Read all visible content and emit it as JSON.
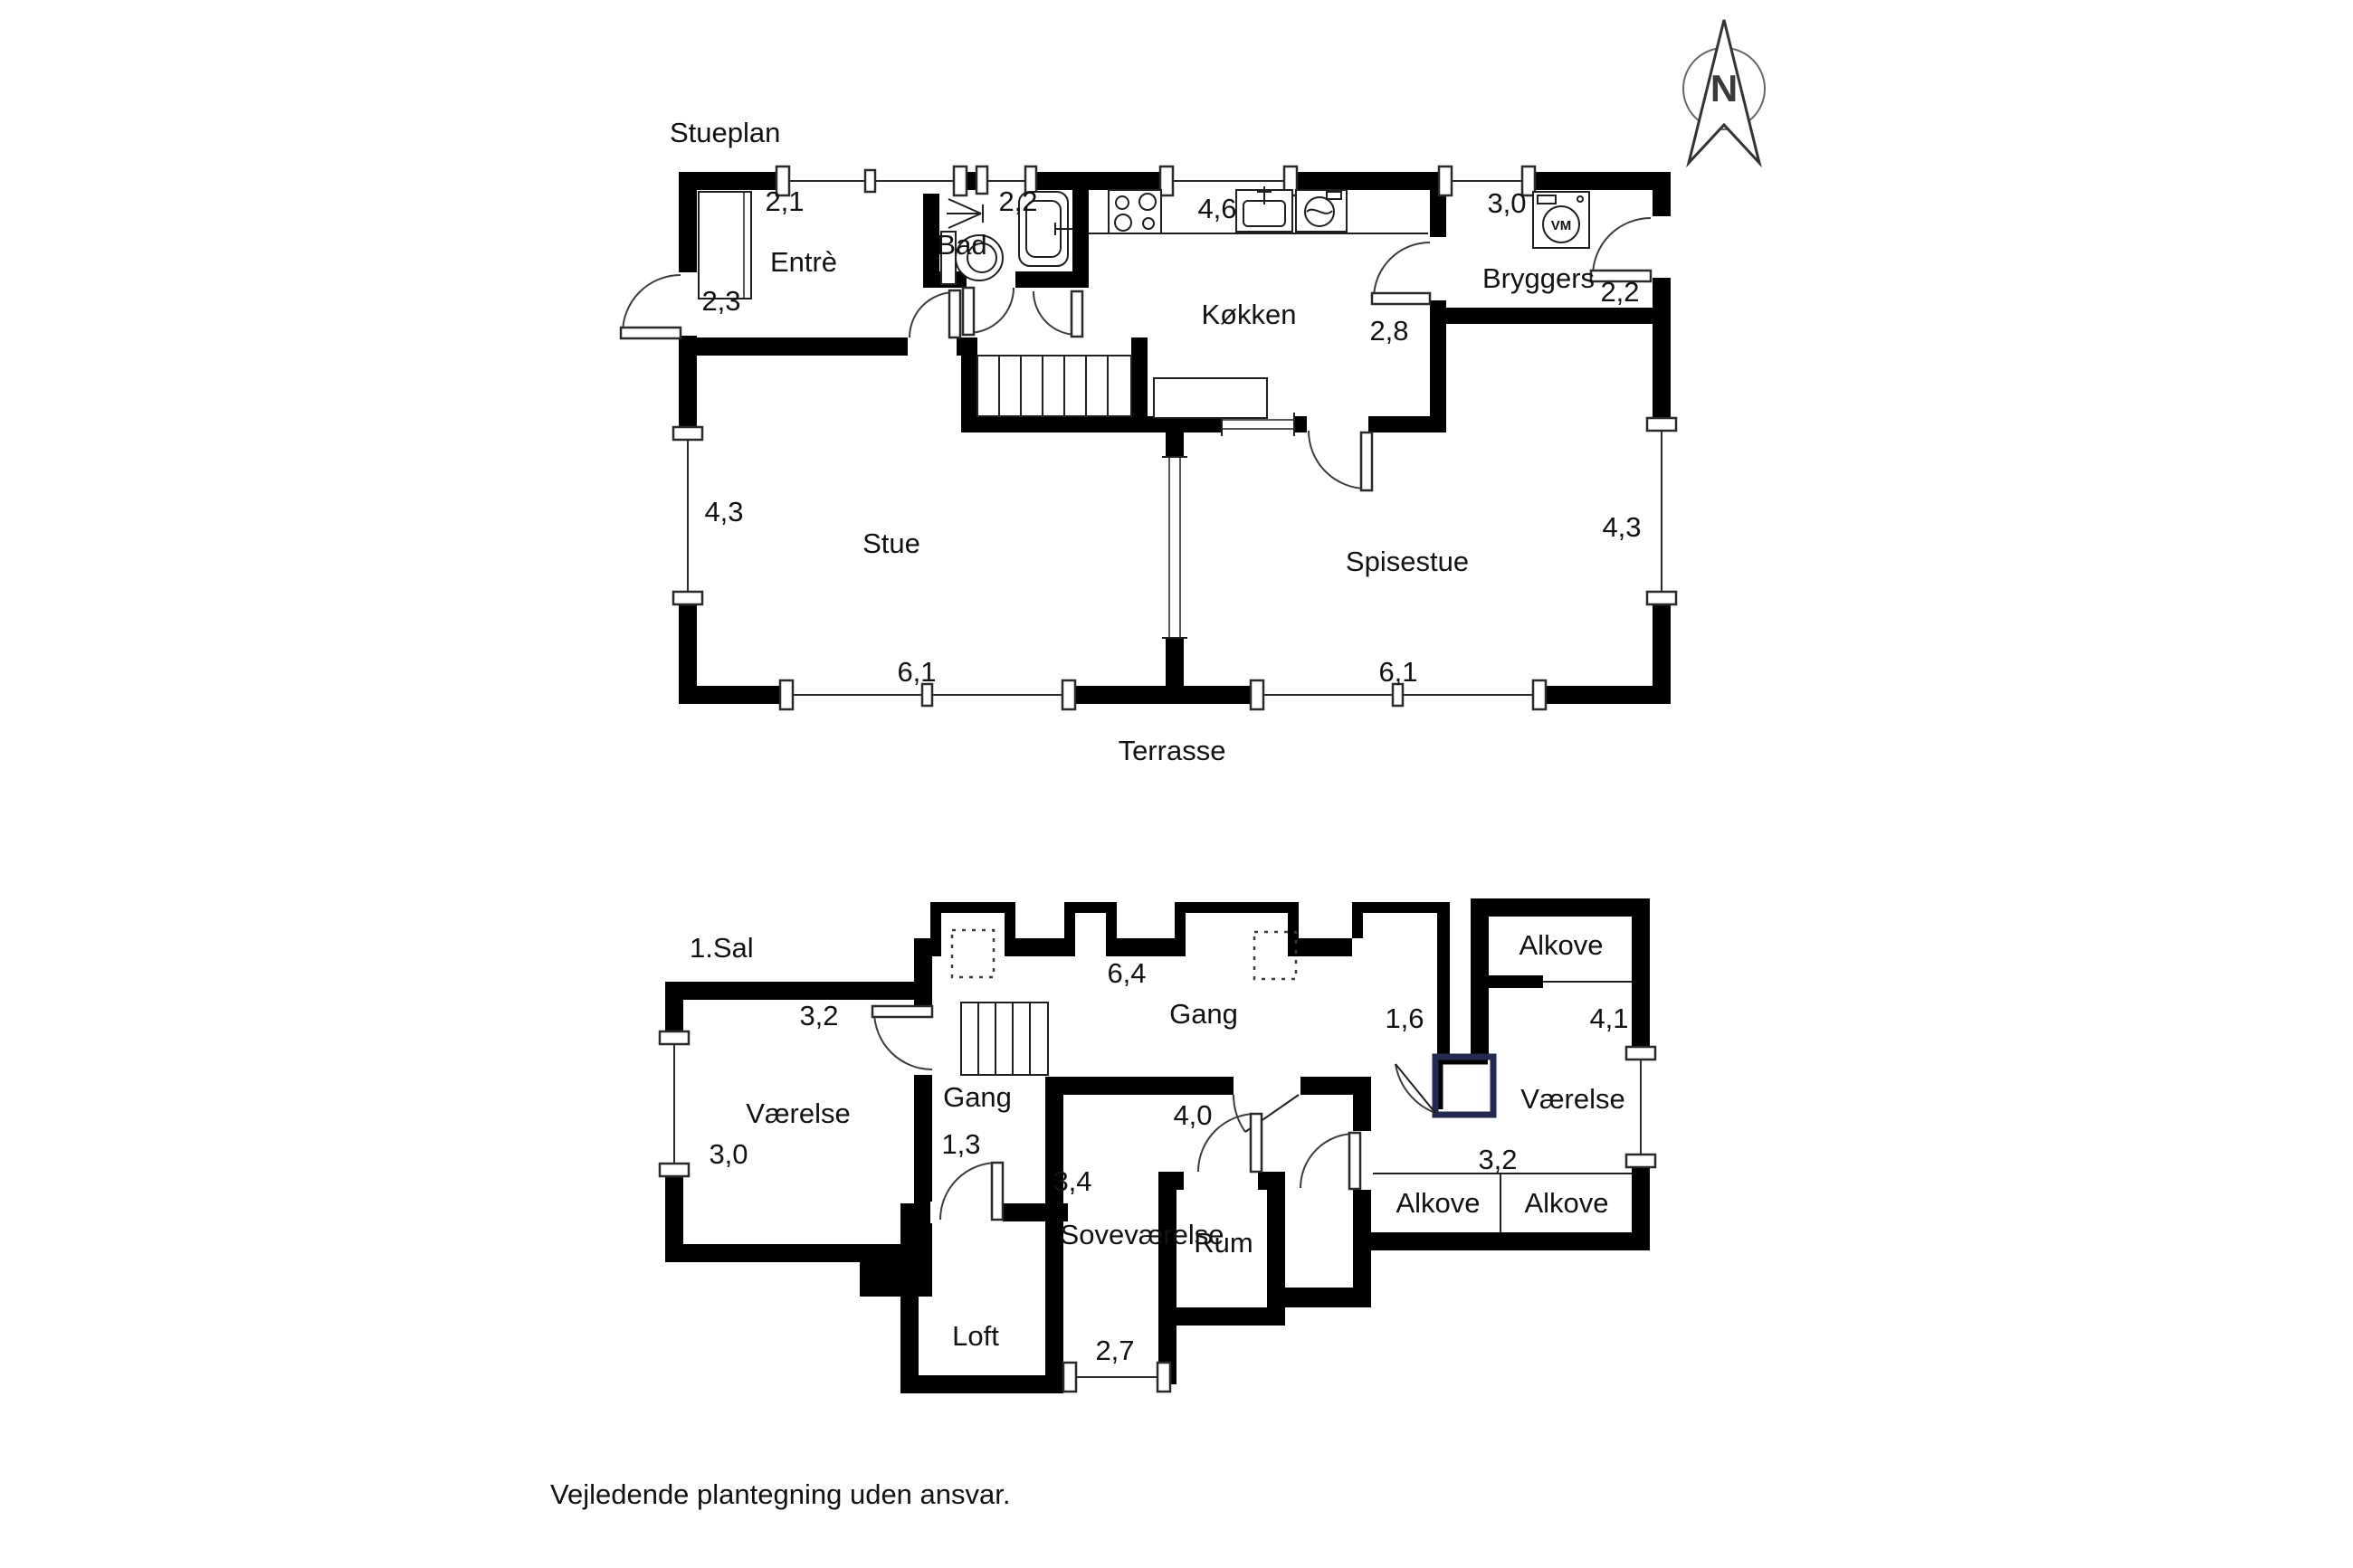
{
  "page": {
    "disclaimer": "Vejledende plantegning uden ansvar."
  },
  "compass": {
    "letter": "N"
  },
  "ground_floor": {
    "title": "Stueplan",
    "outdoor_label": "Terrasse",
    "rooms": {
      "entre": "Entrè",
      "bad": "Bad",
      "kokken": "Køkken",
      "bryggers": "Bryggers",
      "stue": "Stue",
      "spisestue": "Spisestue"
    },
    "dims": {
      "entre_width": "2,1",
      "bad_width": "2,2",
      "kokken_width": "4,6",
      "bryggers_width": "3,0",
      "entre_depth": "2,3",
      "kokken_depth": "2,8",
      "bryggers_depth": "2,2",
      "stue_depth": "4,3",
      "spisestue_depth": "4,3",
      "stue_width": "6,1",
      "spisestue_width": "6,1"
    },
    "appliances": {
      "washing_machine": "VM"
    }
  },
  "first_floor": {
    "title": "1.Sal",
    "rooms": {
      "vaerelse_left": "Værelse",
      "gang_upper": "Gang",
      "gang_lower": "Gang",
      "sovevaerelse": "Soveværelse",
      "rum": "Rum",
      "loft": "Loft",
      "alkove_top": "Alkove",
      "vaerelse_right": "Værelse",
      "alkove_bottom_left": "Alkove",
      "alkove_bottom_right": "Alkove"
    },
    "dims": {
      "vaerelse_left_width": "3,2",
      "vaerelse_left_depth": "3,0",
      "gang_upper_width": "6,4",
      "gang_upper_depth": "1,6",
      "vaerelse_right_depth": "4,1",
      "gang_lower_width": "1,3",
      "sovevaerelse_width": "4,0",
      "sovevaerelse_depth": "3,4",
      "sovevaerelse_window": "2,7",
      "vaerelse_right_width": "3,2"
    }
  }
}
